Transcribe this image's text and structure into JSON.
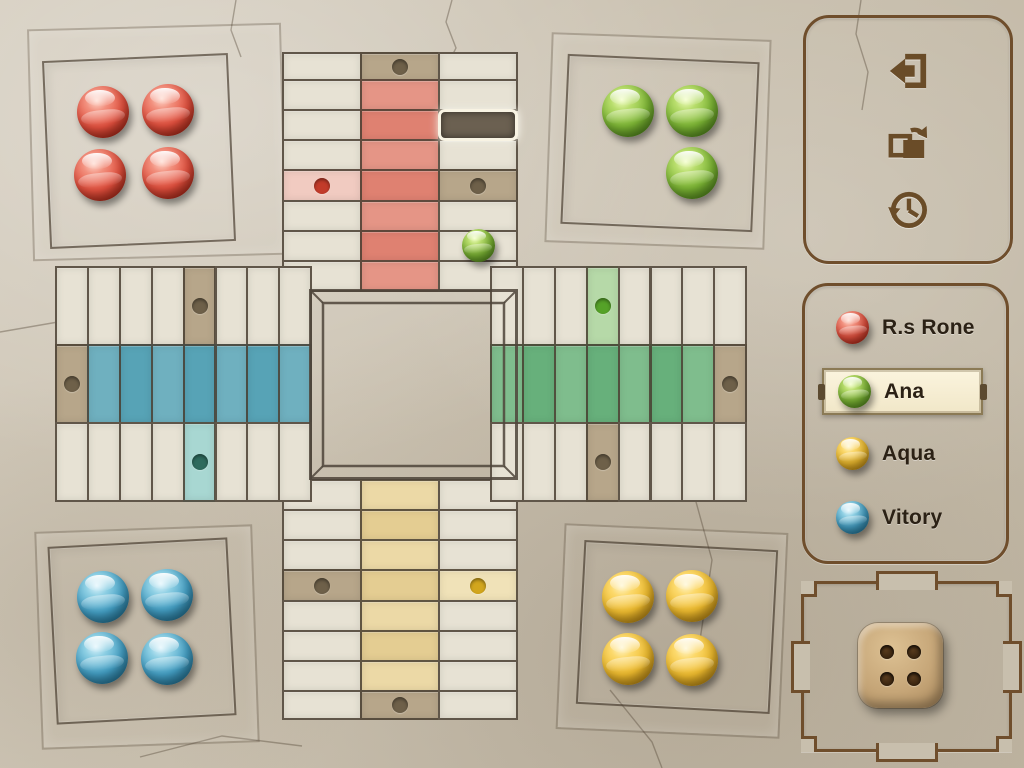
{
  "screen": {
    "width": 1024,
    "height": 768,
    "theme": "stone-parchis"
  },
  "sidebar": {
    "actions": [
      {
        "id": "exit",
        "icon": "exit-icon"
      },
      {
        "id": "rotate",
        "icon": "rotate-screen-icon"
      },
      {
        "id": "history",
        "icon": "history-icon"
      }
    ],
    "players": [
      {
        "label": "R.s Rone",
        "color": "red",
        "active": false,
        "top": 304
      },
      {
        "label": "Ana",
        "color": "green",
        "active": true,
        "top": 368
      },
      {
        "label": "Aqua",
        "color": "yellow",
        "active": false,
        "top": 430
      },
      {
        "label": "Vitory",
        "color": "blue",
        "active": false,
        "top": 494
      }
    ],
    "dice": {
      "value": 4
    }
  },
  "board": {
    "palette": {
      "base": "#e7e2d4",
      "tan": "#b7a68a",
      "redA": "#e59586",
      "redB": "#df8171",
      "redStart": "#f1cbc1",
      "blueA": "#6fb0bf",
      "blueB": "#57a3b6",
      "blueStart": "#a8d7d2",
      "greenA": "#7fbd8d",
      "greenB": "#67b07b",
      "greenStart": "#b6d9a8",
      "yellowA": "#ecd9a6",
      "yellowB": "#e4cd92",
      "yellowStart": "#f0e2b8",
      "dots": {
        "dark": "#6e6049",
        "red": "#c23b2a",
        "teal": "#2e6b5e",
        "green": "#55a228",
        "yellow": "#d2a61d"
      },
      "line": "#4e443a",
      "panel_border": "#6f4e2c",
      "text": "#2b2115",
      "highlight_bg": "#6b6051",
      "highlight_border": "#f8f3e3"
    },
    "arms": [
      {
        "id": "top-cap",
        "x": 282,
        "y": 52,
        "cols": 3,
        "rows": 1,
        "cw": 78,
        "ch": 28,
        "cells": [
          {
            "r": 0,
            "c": 1,
            "bg": "tan",
            "dot": "dark"
          }
        ]
      },
      {
        "id": "top-arm",
        "x": 282,
        "y": 79,
        "cols": 3,
        "rows": 7,
        "cw": 78,
        "ch": 30.15,
        "cells": [
          {
            "r": 0,
            "c": 1,
            "bg": "redA"
          },
          {
            "r": 1,
            "c": 1,
            "bg": "redB"
          },
          {
            "r": 2,
            "c": 1,
            "bg": "redA"
          },
          {
            "r": 3,
            "c": 1,
            "bg": "redB"
          },
          {
            "r": 4,
            "c": 1,
            "bg": "redA"
          },
          {
            "r": 5,
            "c": 1,
            "bg": "redB"
          },
          {
            "r": 6,
            "c": 1,
            "bg": "redA"
          },
          {
            "r": 3,
            "c": 0,
            "bg": "redStart",
            "dot": "red"
          },
          {
            "r": 3,
            "c": 2,
            "bg": "tan",
            "dot": "dark"
          },
          {
            "r": 1,
            "c": 2,
            "highlight": true
          }
        ]
      },
      {
        "id": "bottom-arm",
        "x": 282,
        "y": 479,
        "cols": 3,
        "rows": 7,
        "cw": 78,
        "ch": 30.15,
        "cells": [
          {
            "r": 0,
            "c": 1,
            "bg": "yellowA"
          },
          {
            "r": 1,
            "c": 1,
            "bg": "yellowB"
          },
          {
            "r": 2,
            "c": 1,
            "bg": "yellowA"
          },
          {
            "r": 3,
            "c": 1,
            "bg": "yellowB"
          },
          {
            "r": 4,
            "c": 1,
            "bg": "yellowA"
          },
          {
            "r": 5,
            "c": 1,
            "bg": "yellowB"
          },
          {
            "r": 6,
            "c": 1,
            "bg": "yellowA"
          },
          {
            "r": 3,
            "c": 0,
            "bg": "tan",
            "dot": "dark"
          },
          {
            "r": 3,
            "c": 2,
            "bg": "yellowStart",
            "dot": "yellow"
          }
        ]
      },
      {
        "id": "bottom-cap",
        "x": 282,
        "y": 690,
        "cols": 3,
        "rows": 1,
        "cw": 78,
        "ch": 28,
        "cells": [
          {
            "r": 0,
            "c": 1,
            "bg": "tan",
            "dot": "dark"
          }
        ]
      },
      {
        "id": "left-arm",
        "x": 55,
        "y": 266,
        "cols": 8,
        "rows": 3,
        "cw": 31.9,
        "ch": 78,
        "cells": [
          {
            "r": 1,
            "c": 0,
            "bg": "tan",
            "dot": "dark"
          },
          {
            "r": 1,
            "c": 1,
            "bg": "blueA"
          },
          {
            "r": 1,
            "c": 2,
            "bg": "blueB"
          },
          {
            "r": 1,
            "c": 3,
            "bg": "blueA"
          },
          {
            "r": 1,
            "c": 4,
            "bg": "blueB"
          },
          {
            "r": 1,
            "c": 5,
            "bg": "blueA"
          },
          {
            "r": 1,
            "c": 6,
            "bg": "blueB"
          },
          {
            "r": 1,
            "c": 7,
            "bg": "blueA"
          },
          {
            "r": 0,
            "c": 4,
            "bg": "tan",
            "dot": "dark"
          },
          {
            "r": 2,
            "c": 4,
            "bg": "blueStart",
            "dot": "teal"
          }
        ]
      },
      {
        "id": "right-arm",
        "x": 490,
        "y": 266,
        "cols": 8,
        "rows": 3,
        "cw": 31.9,
        "ch": 78,
        "cells": [
          {
            "r": 1,
            "c": 0,
            "bg": "greenA"
          },
          {
            "r": 1,
            "c": 1,
            "bg": "greenB"
          },
          {
            "r": 1,
            "c": 2,
            "bg": "greenA"
          },
          {
            "r": 1,
            "c": 3,
            "bg": "greenB"
          },
          {
            "r": 1,
            "c": 4,
            "bg": "greenA"
          },
          {
            "r": 1,
            "c": 5,
            "bg": "greenB"
          },
          {
            "r": 1,
            "c": 6,
            "bg": "greenA"
          },
          {
            "r": 1,
            "c": 7,
            "bg": "tan",
            "dot": "dark"
          },
          {
            "r": 0,
            "c": 3,
            "bg": "greenStart",
            "dot": "green"
          },
          {
            "r": 2,
            "c": 3,
            "bg": "tan",
            "dot": "dark"
          }
        ]
      }
    ],
    "center": {
      "x": 309,
      "y": 289,
      "w": 209,
      "h": 191,
      "inset": 14
    },
    "homes": [
      {
        "color": "red",
        "x": 46,
        "y": 57,
        "w": 182,
        "h": 184,
        "rot": -2.5
      },
      {
        "color": "green",
        "x": 564,
        "y": 58,
        "w": 188,
        "h": 166,
        "rot": 2.5
      },
      {
        "color": "blue",
        "x": 52,
        "y": 542,
        "w": 176,
        "h": 174,
        "rot": -3
      },
      {
        "color": "yellow",
        "x": 580,
        "y": 545,
        "w": 190,
        "h": 160,
        "rot": 3
      }
    ],
    "slabs": [
      {
        "x": 30,
        "y": 26,
        "w": 250,
        "h": 228,
        "rot": -1.5
      },
      {
        "x": 548,
        "y": 36,
        "w": 216,
        "h": 206,
        "rot": 2
      },
      {
        "x": 38,
        "y": 528,
        "w": 214,
        "h": 214,
        "rot": -2
      },
      {
        "x": 560,
        "y": 528,
        "w": 220,
        "h": 202,
        "rot": 2.5
      }
    ],
    "balls": [
      {
        "color": "red",
        "cx": 103,
        "cy": 112,
        "d": 52
      },
      {
        "color": "red",
        "cx": 168,
        "cy": 110,
        "d": 52
      },
      {
        "color": "red",
        "cx": 100,
        "cy": 175,
        "d": 52
      },
      {
        "color": "red",
        "cx": 168,
        "cy": 173,
        "d": 52
      },
      {
        "color": "green",
        "cx": 628,
        "cy": 111,
        "d": 52
      },
      {
        "color": "green",
        "cx": 692,
        "cy": 111,
        "d": 52
      },
      {
        "color": "green",
        "cx": 692,
        "cy": 173,
        "d": 52
      },
      {
        "color": "green",
        "cx": 478,
        "cy": 245,
        "d": 33,
        "on_track": true
      },
      {
        "color": "blue",
        "cx": 103,
        "cy": 597,
        "d": 52
      },
      {
        "color": "blue",
        "cx": 167,
        "cy": 595,
        "d": 52
      },
      {
        "color": "blue",
        "cx": 102,
        "cy": 658,
        "d": 52
      },
      {
        "color": "blue",
        "cx": 167,
        "cy": 659,
        "d": 52
      },
      {
        "color": "yellow",
        "cx": 628,
        "cy": 597,
        "d": 52
      },
      {
        "color": "yellow",
        "cx": 692,
        "cy": 596,
        "d": 52
      },
      {
        "color": "yellow",
        "cx": 628,
        "cy": 659,
        "d": 52
      },
      {
        "color": "yellow",
        "cx": 692,
        "cy": 660,
        "d": 52
      }
    ]
  }
}
